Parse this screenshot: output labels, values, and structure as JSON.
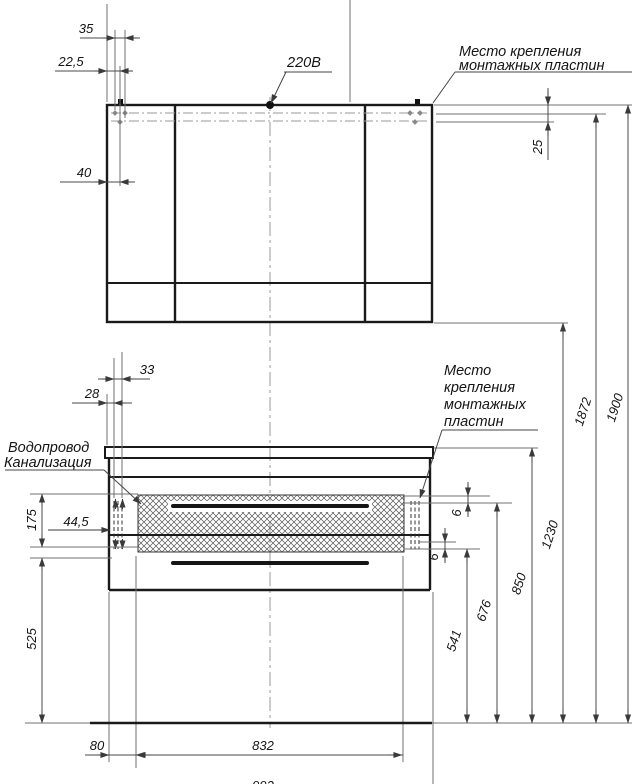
{
  "drawing": {
    "kind": "furniture-installation-drawing",
    "units": "mm",
    "annotations": {
      "power_outlet": "220В",
      "mounting_plates_top": [
        "Место крепления",
        "монтажных пластин"
      ],
      "mounting_plates_bottom": [
        "Место",
        "крепления",
        "монтажных",
        "пластин"
      ],
      "water_supply": "Водопровод",
      "sewerage": "Канализация"
    },
    "dims": {
      "d35": "35",
      "d22_5": "22,5",
      "d40": "40",
      "d25": "25",
      "d33": "33",
      "d28": "28",
      "d175": "175",
      "d44_5": "44,5",
      "d6a": "6",
      "d6b": "6",
      "d541": "541",
      "d676": "676",
      "d850": "850",
      "d1230": "1230",
      "d1872": "1872",
      "d1900": "1900",
      "d525": "525",
      "d80": "80",
      "d832": "832",
      "d992": "992"
    }
  }
}
